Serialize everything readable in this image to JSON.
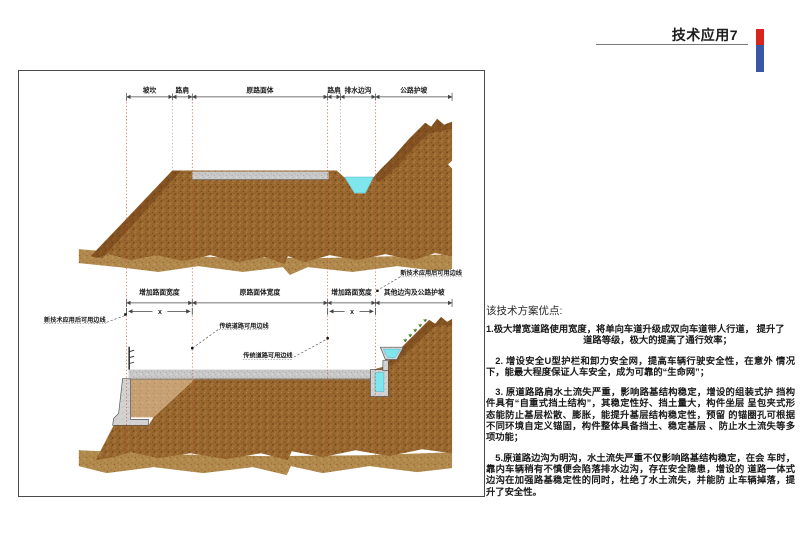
{
  "header": {
    "title": "技术应用7",
    "accent": {
      "red": "#d8251d",
      "blue": "#3a57a7"
    }
  },
  "figure": {
    "top_labels": [
      "坡坎",
      "路肩",
      "原路面体",
      "路肩",
      "排水边沟",
      "公路护坡"
    ],
    "bottom_labels": [
      "增加路面宽度",
      "原路面体宽度",
      "增加路面宽度",
      "其他边沟及公路护坡"
    ],
    "x_label": "x",
    "callouts": {
      "new_edge_right": "新技术应用后可用边线",
      "new_edge_left": "新技术应用后可用边线",
      "trad_edge_upper": "传统道路可用边线",
      "trad_edge_lower": "传统道路可用边线"
    },
    "colors": {
      "soil": "#99682f",
      "soil_dark": "#6a3a12",
      "soil_light": "#b28a4e",
      "backfill": "#c7a173",
      "road": "#c9c9c9",
      "concrete": "#d3d3d3",
      "water": "#7fe6ee",
      "guide": "#cc5544",
      "vegetation": "#4a7d28"
    }
  },
  "notes": {
    "heading": "该技术方案优点:",
    "p1_line1": "1.极大增宽道路使用宽度，将单向车道升级成双向车道带人行道， 提升了",
    "p1_line2": "道路等级，极大的提高了通行效率；",
    "p2": "2. 增设安全U型护栏和卸力安全网，提高车辆行驶安全性，在意外 情况下，能最大程度保证人车安全，成为可靠的“生命网”；",
    "p3": "3. 原道路路肩水土流失严重，影响路基结构稳定，增设的组装式护 挡构件具有“自重式挡土结构”，其稳定性好、挡土量大，构件坐层 呈包夹式形态能防止基层松散、膨胀，能提升基层结构稳定性，预留 的锚圈孔可根据不同环境自定义锚固，构件整体具备挡土、稳定基层 、防止水土流失等多项功能；",
    "p4": "5.原道路边沟为明沟，水土流失严重不仅影响路基结构稳定，在会 车时，靠内车辆稍有不慎便会陷落排水边沟，存在安全隐患，增设的 道路一体式边沟在加强路基稳定性的同时，杜绝了水土流失，并能防 止车辆掉落，提升了安全性。"
  }
}
